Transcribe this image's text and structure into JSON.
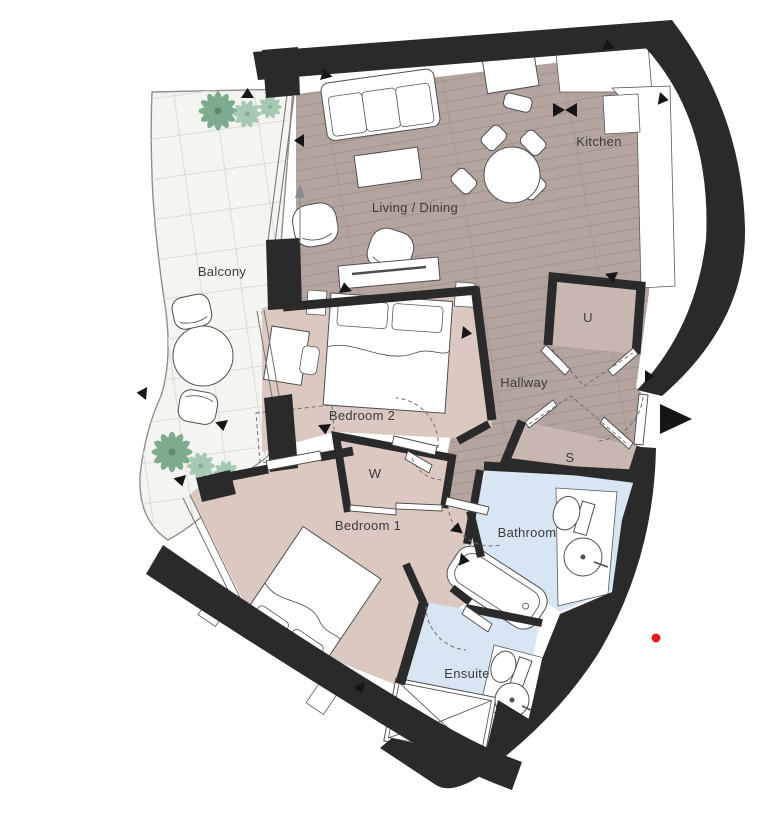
{
  "plan": {
    "title": "Apartment floor plan",
    "rooms": {
      "balcony": "Balcony",
      "living_dining": "Living / Dining",
      "kitchen": "Kitchen",
      "hallway": "Hallway",
      "bedroom2": "Bedroom 2",
      "bedroom1": "Bedroom 1",
      "bathroom": "Bathroom",
      "ensuite": "Ensuite",
      "utility_cupboard": "U",
      "storage_cupboard": "S",
      "wardrobe": "W"
    },
    "colors": {
      "wall": "#2a2a2a",
      "wood_floor": "#b3a49f",
      "wood_line": "#9b8c88",
      "bedroom_floor": "#dbc9c1",
      "cupboard_floor": "#c8b7b1",
      "wet_room_floor": "#d8e5f3",
      "balcony_floor": "#f4f4f1",
      "plant": "#7dab8d",
      "plant_light": "#a8c9b1",
      "marker_dot": "#e02020"
    }
  }
}
